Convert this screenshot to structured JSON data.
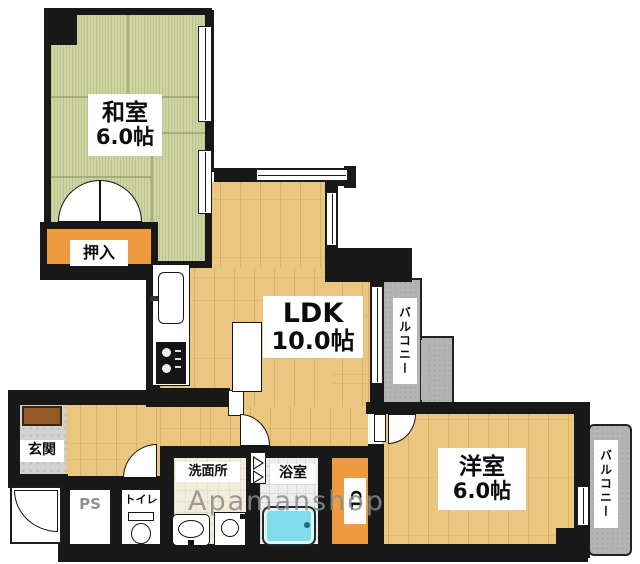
{
  "floorplan": {
    "watermark": "Apamanshop",
    "rooms": {
      "washitsu": {
        "name": "和室",
        "size": "6.0帖"
      },
      "oshiire": {
        "name": "押入"
      },
      "ldk": {
        "name": "LDK",
        "size": "10.0帖"
      },
      "balcony_ldk": {
        "name": "バルコニー"
      },
      "yoshitsu": {
        "name": "洋室",
        "size": "6.0帖"
      },
      "balcony_yoshitsu": {
        "name": "バルコニー"
      },
      "genkan": {
        "name": "玄関"
      },
      "pipe_space": {
        "name": "PS"
      },
      "toilet": {
        "name": "トイレ"
      },
      "washroom": {
        "name": "洗面所"
      },
      "bathroom": {
        "name": "浴室"
      },
      "closet": {
        "name": "CL"
      }
    },
    "colors": {
      "tatami_green": "#ced4a2",
      "wood_floor": "#eac67e",
      "closet_orange": "#ee9b40",
      "balcony_gray": "#b4b4b4",
      "bathtub_cyan": "#7fdce8",
      "wall_black": "#181818",
      "entrance_tile_gray": "#d2d2d2",
      "watermark_gray": "#8b8b8b"
    },
    "icons": {
      "kitchen_sink": "kitchen-sink-icon",
      "stove": "stove-icon",
      "toilet": "toilet-icon",
      "washbasin": "washbasin-icon",
      "washing_machine": "washing-machine-icon",
      "bathtub": "bathtub-icon",
      "shoe_cabinet": "shoe-cabinet-icon"
    }
  }
}
